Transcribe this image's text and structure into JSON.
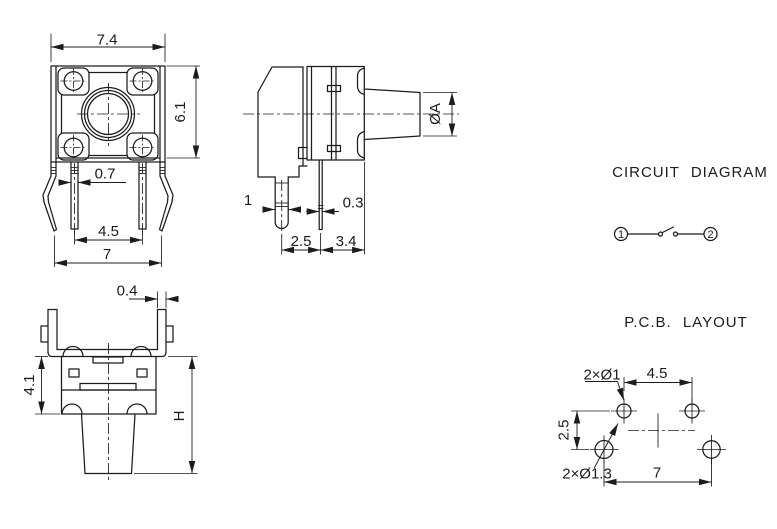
{
  "drawing": {
    "front_view": {
      "dim_width": "7.4",
      "dim_height": "6.1",
      "dim_lead_width": "0.7",
      "dim_lead_pitch": "4.5",
      "dim_outer_span": "7"
    },
    "side_view": {
      "dim_knob_dia": "ØA",
      "dim_boss_width": "1",
      "dim_lead_thickness": "0.3",
      "dim_boss_offset": "2.5",
      "dim_lead_offset": "3.4"
    },
    "mount_view": {
      "dim_bracket_thickness": "0.4",
      "dim_body_height": "4.1",
      "dim_total_height": "H"
    },
    "circuit": {
      "title": "CIRCUIT DIAGRAM",
      "terminal_left": "1",
      "terminal_right": "2"
    },
    "pcb": {
      "title": "P.C.B. LAYOUT",
      "label_small_holes": "2×Ø1",
      "label_large_holes": "2×Ø1.3",
      "dim_top_pitch": "4.5",
      "dim_row_pitch": "2.5",
      "dim_bottom_pitch": "7"
    }
  }
}
